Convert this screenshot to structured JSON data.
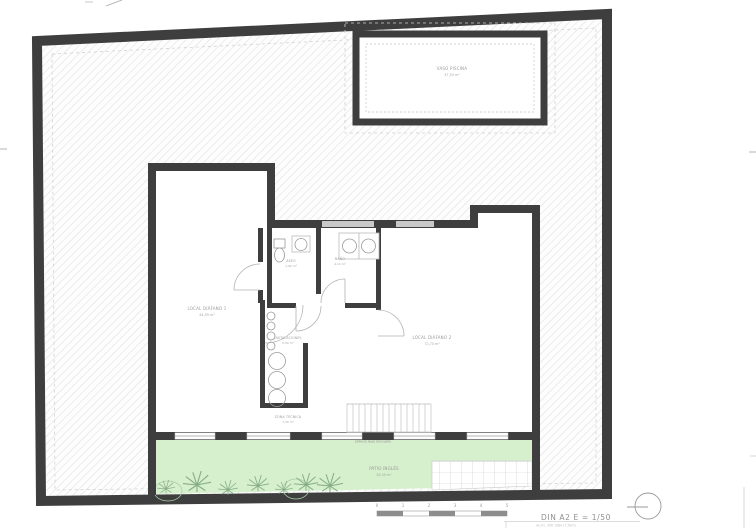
{
  "sheet": {
    "format_scale": "DIN A2  E = 1/50",
    "sheet_note": "Av.91, 456 1984 (7,5km)"
  },
  "rooms": {
    "pool": {
      "name": "VASO PISCINA",
      "area": "37,50 m²"
    },
    "local1": {
      "name": "LOCAL DIÁFANO 1",
      "area": "44,95 m²"
    },
    "aseo": {
      "name": "ASEO",
      "area": "1,90 m²"
    },
    "bano": {
      "name": "BAÑO",
      "area": "4,10 m²"
    },
    "instalaciones": {
      "name": "INSTALACIONES",
      "area": "5,50 m²"
    },
    "local2": {
      "name": "LOCAL DIÁFANO 2",
      "area": "72,70 m²"
    },
    "zona_tecnica": {
      "name": "ZONA TÉCNICA",
      "area": "7,30 m²"
    },
    "patio": {
      "name": "PATIO INGLÉS",
      "area": "28,50 m²"
    }
  },
  "annotations": {
    "under_stairs": "ESPACIO BAJO ESCALERA"
  },
  "scale_bar": {
    "ticks": [
      "0",
      "1",
      "2",
      "3",
      "4",
      "5"
    ]
  },
  "colors": {
    "wall": "#3e3e3e",
    "hatch_line": "#d9d9d9",
    "garden": "#d6efcd",
    "window": "#c9c9c9",
    "label": "#9a9a9a"
  }
}
